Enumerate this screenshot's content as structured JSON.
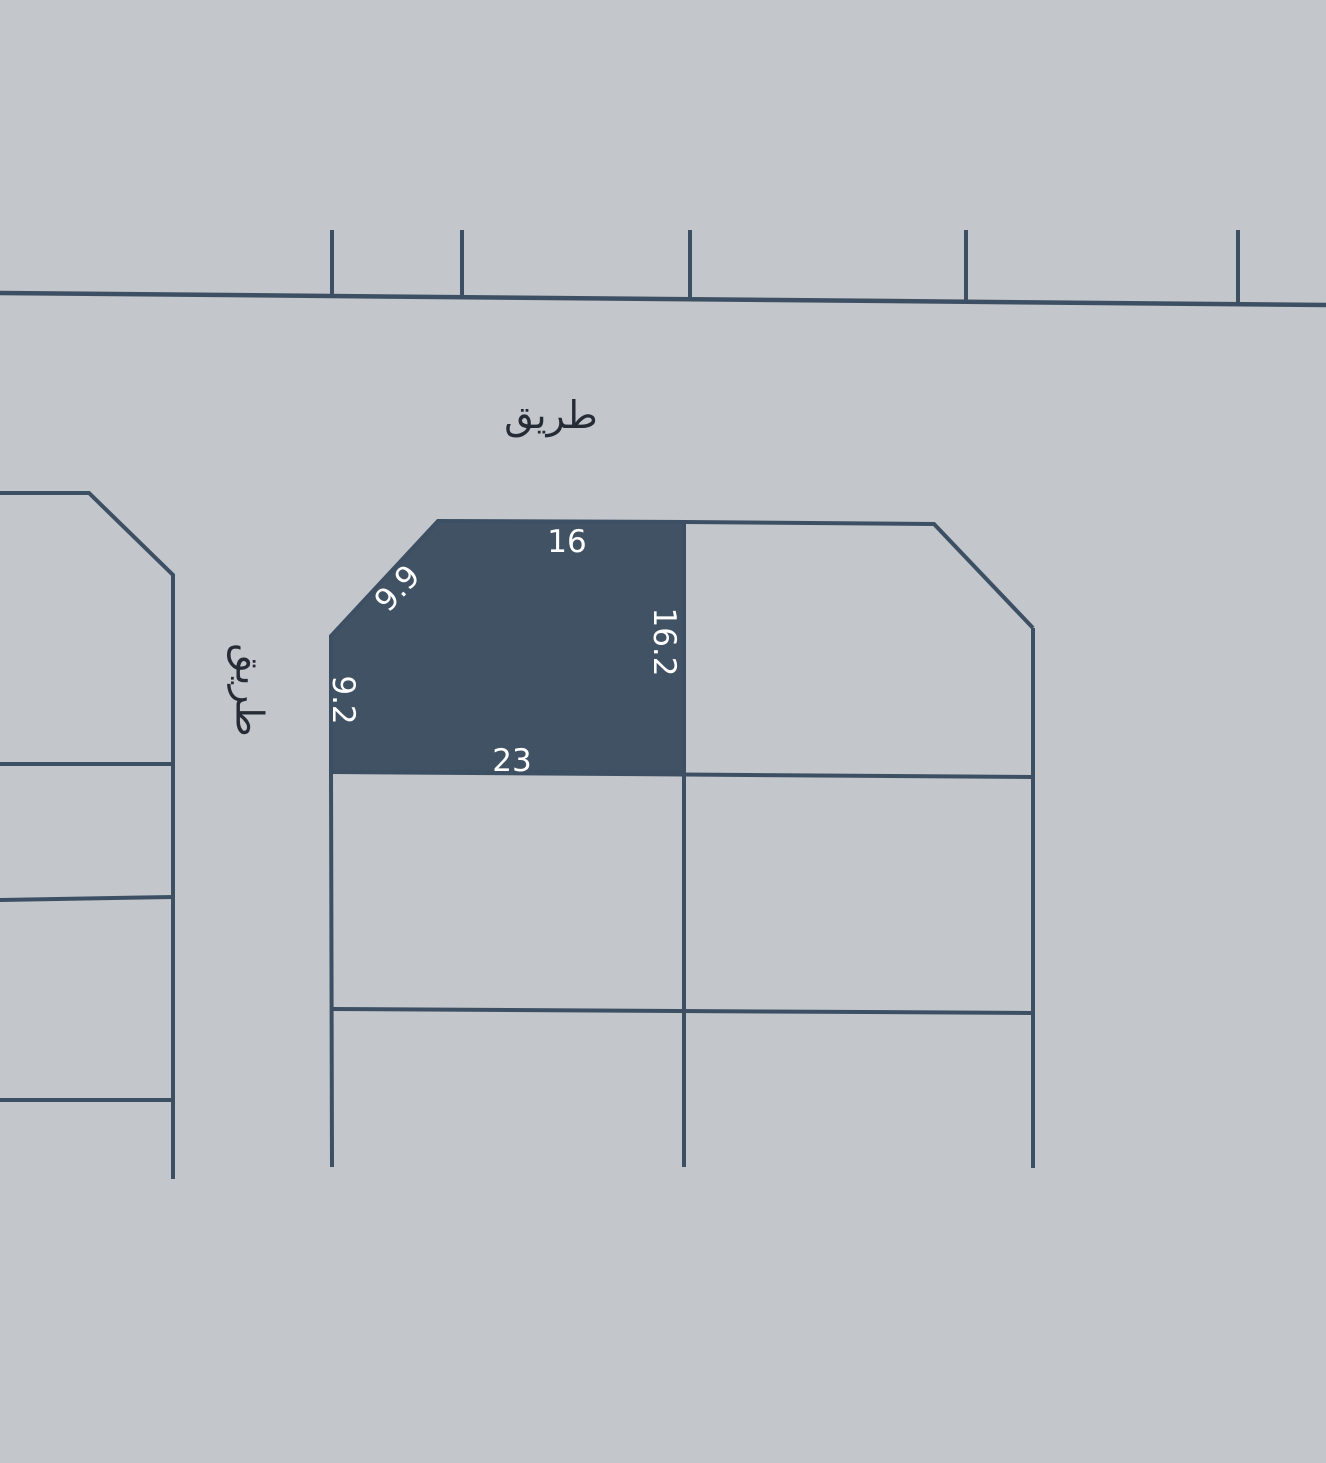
{
  "colors": {
    "bg": "#c3c6ca",
    "line": "#3d4f63",
    "highlight": "#405264",
    "dim_label": "#ffffff",
    "road_label": "#262c35"
  },
  "roads": {
    "top_label": "طريق",
    "left_label": "طريق"
  },
  "highlighted_plot": {
    "dim_top": "16",
    "dim_diagonal": "9.9",
    "dim_right": "16.2",
    "dim_left": "9.2",
    "dim_bottom": "23"
  }
}
